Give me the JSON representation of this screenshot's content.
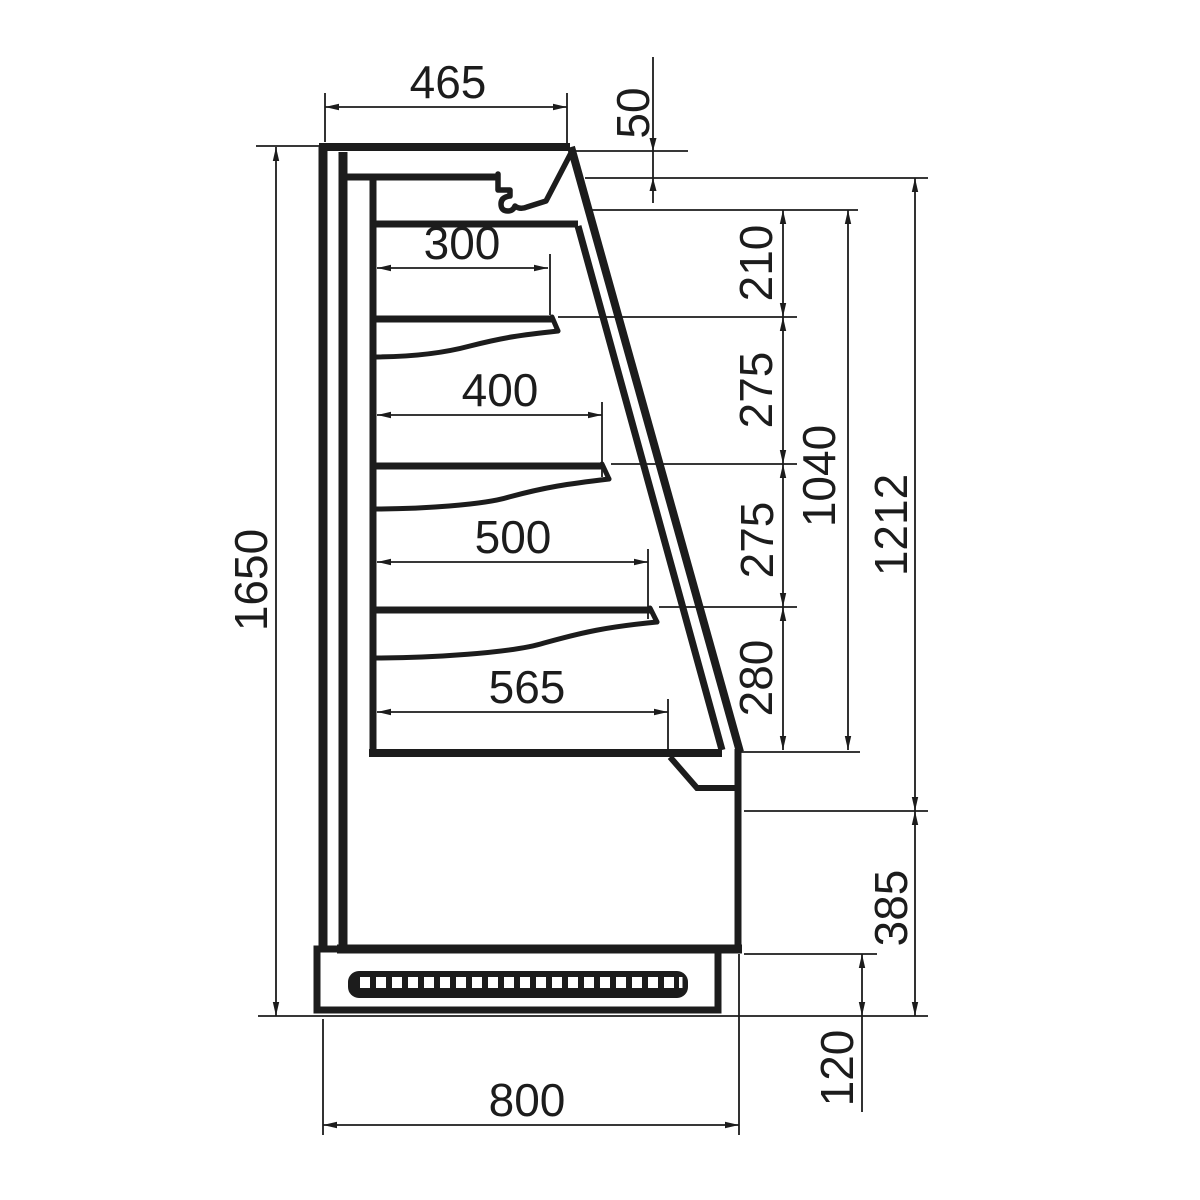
{
  "drawing": {
    "type_label": "side-section technical drawing of tiered open display cabinet",
    "line_color": "#1c1c1c",
    "background_color": "#ffffff"
  },
  "dimensions": {
    "top_depth": "465",
    "canopy_front_height": "50",
    "shelf_1_depth": "300",
    "shelf_2_depth": "400",
    "shelf_3_depth": "500",
    "base_shelf_depth": "565",
    "ceiling_to_shelf_1": "210",
    "shelf_1_to_shelf_2": "275",
    "shelf_2_to_shelf_3": "275",
    "shelf_3_to_base": "280",
    "interior_height": "1040",
    "opening_height": "1212",
    "total_height": "1650",
    "lower_front_height": "385",
    "plinth_height": "120",
    "total_depth": "800"
  },
  "grille": {
    "slot_count": 20
  }
}
